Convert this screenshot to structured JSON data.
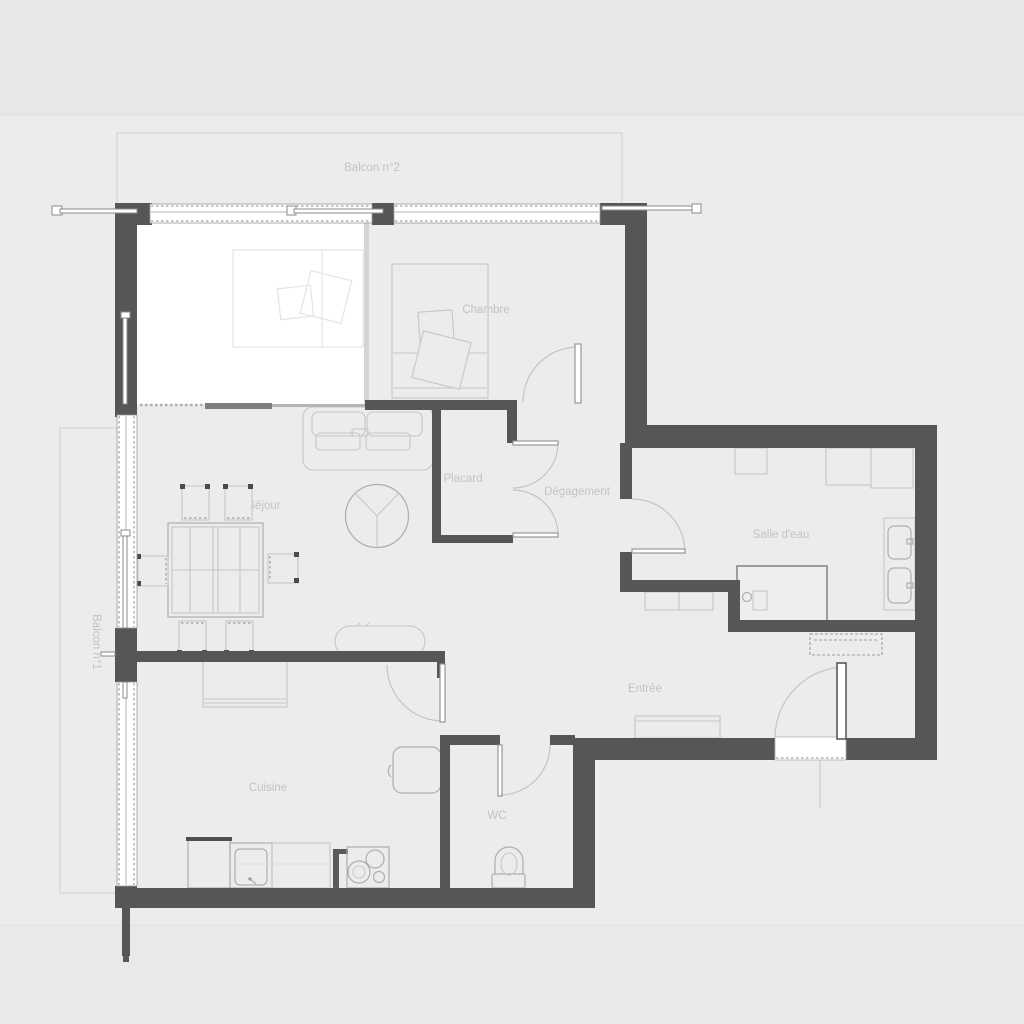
{
  "plan": {
    "rooms": {
      "balcony2": "Balcon n°2",
      "chambre": "Chambre",
      "placard": "Placard",
      "degagement": "Dégagement",
      "salle_deau": "Salle d'eau",
      "sejour": "Séjour",
      "balcony1": "Balcon n°1",
      "entree": "Entrée",
      "cuisine": "Cuisine",
      "wc": "WC"
    },
    "colors": {
      "band-top": "#e7e7e7",
      "band-main": "#ececec",
      "band-bottom": "#e9e9e9",
      "wall": "#565656",
      "furn": "#c6c6c6",
      "furn-strong": "#8f8f8f",
      "label": "#c3c3c7",
      "balcony-outline": "#dadada",
      "highlight-room": "#ffffff"
    }
  }
}
